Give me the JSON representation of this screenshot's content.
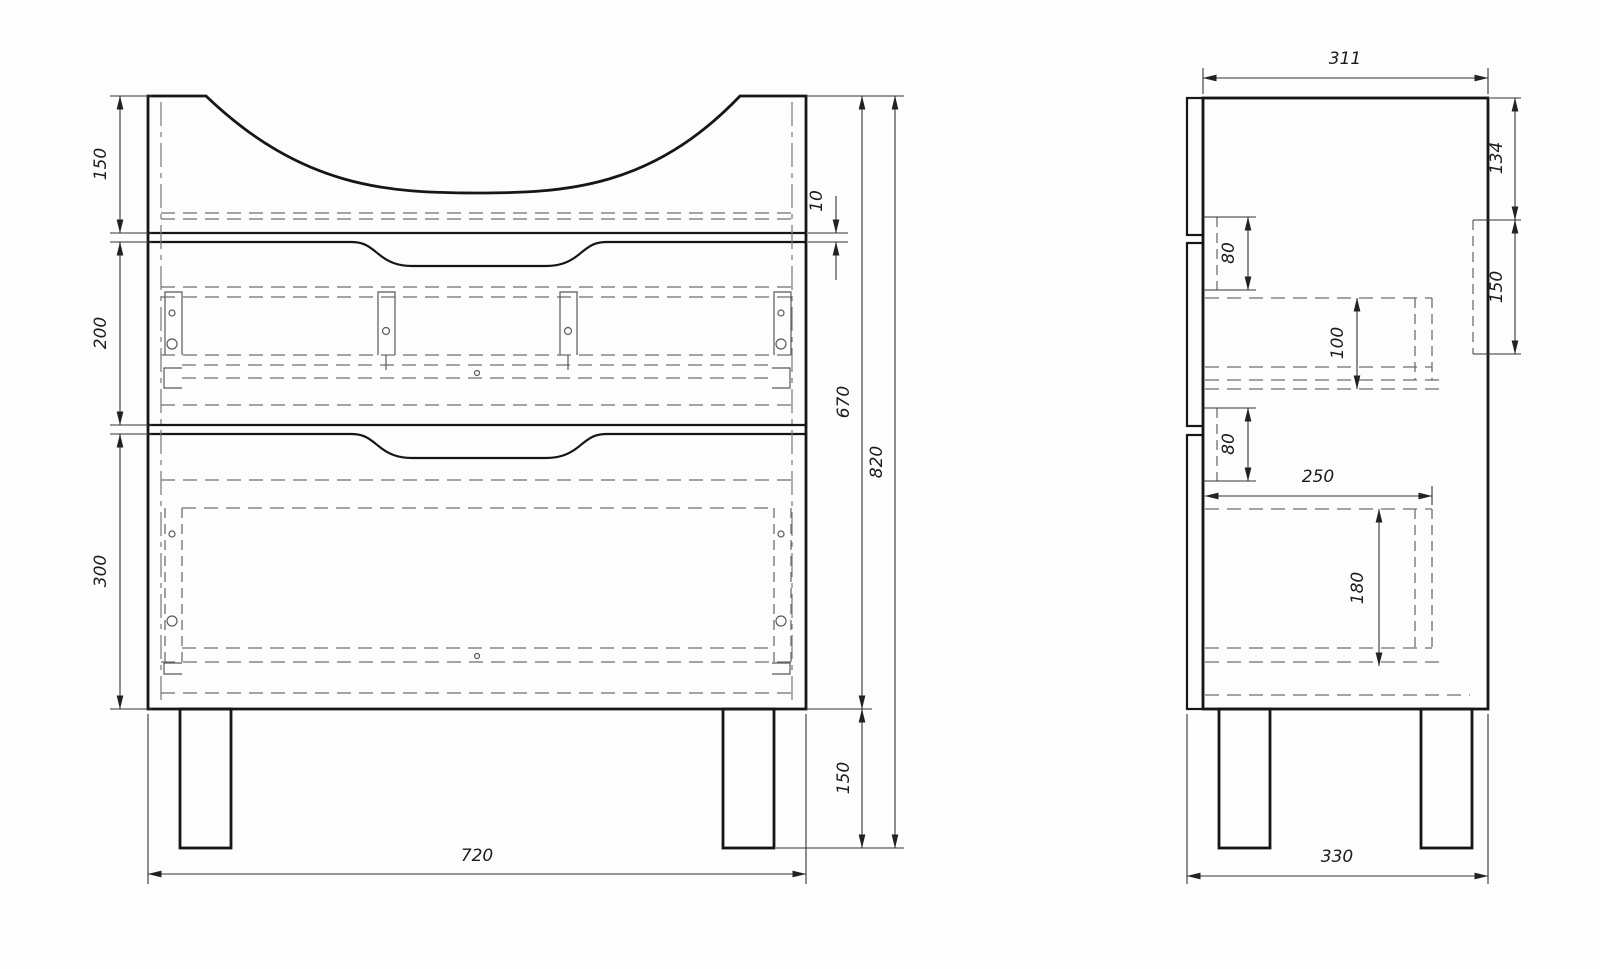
{
  "document": {
    "type": "technical-drawing",
    "subject": "bathroom vanity floor cabinet with basin cutout top, two drawers and four legs",
    "views": [
      "front-view",
      "side-view"
    ],
    "units": "mm",
    "line_colors": {
      "outline": "#161616",
      "hidden": "#6f6f6f",
      "dimension": "#333333"
    },
    "background": "#fdfdfd"
  },
  "front_view": {
    "dimensions": {
      "top_section_height": "150",
      "middle_drawer_height": "200",
      "bottom_drawer_height": "300",
      "panel_gap": "10",
      "carcass_height": "670",
      "overall_height": "820",
      "leg_height": "150",
      "overall_width": "720"
    }
  },
  "side_view": {
    "dimensions": {
      "carcass_depth": "311",
      "back_bracket_top_offset": "134",
      "back_bracket_height": "150",
      "upper_rail_height": "80",
      "middle_drawer_box_height": "100",
      "lower_rail_height": "80",
      "drawer_box_depth": "250",
      "bottom_drawer_box_height": "180",
      "overall_depth": "330"
    }
  }
}
